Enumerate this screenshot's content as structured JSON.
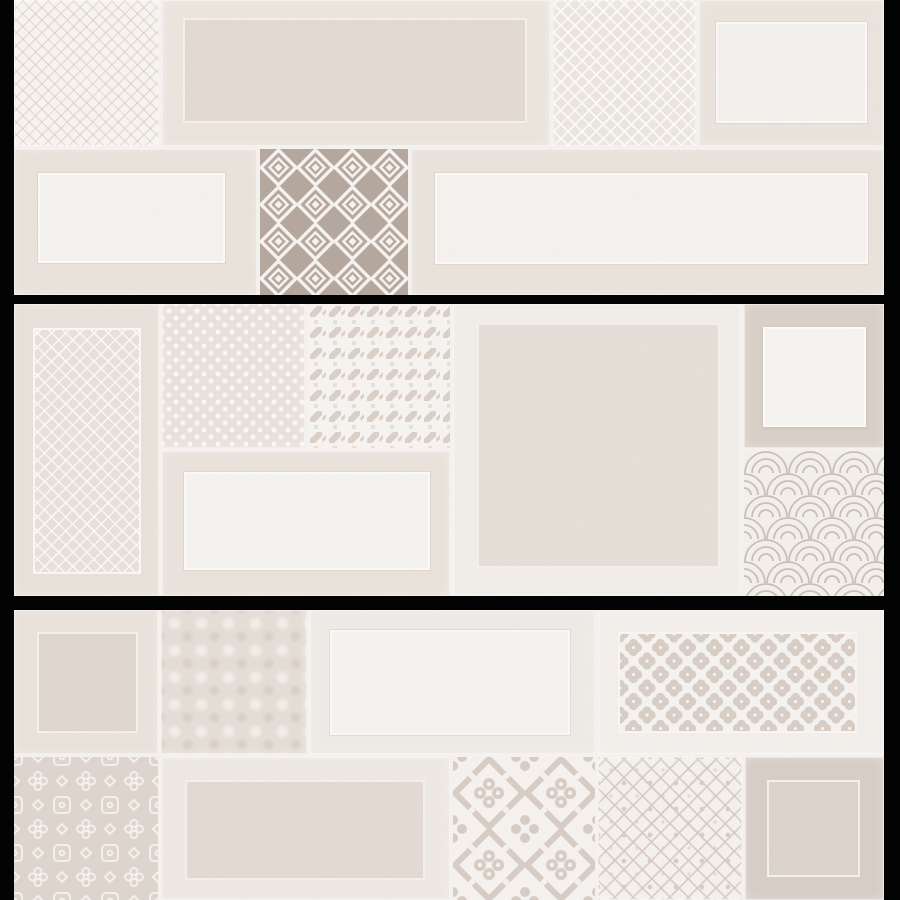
{
  "canvas": {
    "width": 900,
    "height": 900,
    "background": "#030303"
  },
  "panel": {
    "left": 14,
    "right": 884,
    "grout_color": "#f6f3f0"
  },
  "palette": {
    "background_black": "#030303",
    "grout_white": "#f6f3f0",
    "tile_white": "#f7f5f2",
    "tile_light_beige": "#eae4dd",
    "tile_beige": "#e3dbd3",
    "tile_dark_taupe": "#b2a49a",
    "tile_mid_taupe": "#d7cec6",
    "pattern_accent": "#d8cec5"
  },
  "strips": [
    {
      "name": "tile-strip-top",
      "y": 0,
      "height": 295,
      "tiles": [
        {
          "name": "tile-crosshatch",
          "pattern": "crosshatch",
          "x": 14,
          "y": 0,
          "w": 145,
          "h": 146,
          "base": "#f8f5f2"
        },
        {
          "name": "tile-framed-beige-wide",
          "pattern": "plain",
          "x": 162,
          "y": 0,
          "w": 388,
          "h": 146,
          "base": "#ebe5de",
          "inner": {
            "x": 183,
            "y": 18,
            "w": 344,
            "h": 105,
            "style": "dark",
            "fill": "#e2dad2"
          }
        },
        {
          "name": "tile-lattice",
          "pattern": "lattice",
          "x": 553,
          "y": 0,
          "w": 143,
          "h": 146,
          "base": "#ece6e0"
        },
        {
          "name": "tile-framed-blank-small",
          "pattern": "plain",
          "x": 699,
          "y": 0,
          "w": 185,
          "h": 146,
          "base": "#eae4dd",
          "inner": {
            "x": 716,
            "y": 22,
            "w": 151,
            "h": 101,
            "style": "light",
            "fill": "#f4f2ef"
          }
        },
        {
          "name": "tile-framed-blank-left",
          "pattern": "plain",
          "x": 14,
          "y": 149,
          "w": 243,
          "h": 146,
          "base": "#e9e3dc",
          "inner": {
            "x": 38,
            "y": 173,
            "w": 187,
            "h": 90,
            "style": "light",
            "fill": "#f5f3f0"
          }
        },
        {
          "name": "tile-diamond-squares",
          "pattern": "diamond",
          "x": 260,
          "y": 149,
          "w": 148,
          "h": 146,
          "base": "#b2a49a"
        },
        {
          "name": "tile-framed-blank-wide",
          "pattern": "plain",
          "x": 411,
          "y": 149,
          "w": 473,
          "h": 146,
          "base": "#e9e3dc",
          "inner": {
            "x": 435,
            "y": 173,
            "w": 433,
            "h": 91,
            "style": "light",
            "fill": "#f5f3f0"
          }
        }
      ]
    },
    {
      "name": "tile-strip-middle",
      "y": 304,
      "height": 292,
      "tiles": [
        {
          "name": "tile-tall-lattice-framed",
          "pattern": "plain",
          "x": 14,
          "y": 304,
          "w": 145,
          "h": 292,
          "base": "#e8e1da",
          "inner": {
            "x": 33,
            "y": 328,
            "w": 108,
            "h": 246,
            "style": "lattice",
            "fill": "#e8e1da"
          }
        },
        {
          "name": "tile-dot-lattice",
          "pattern": "dots",
          "x": 162,
          "y": 304,
          "w": 143,
          "h": 144,
          "base": "#e9e2db"
        },
        {
          "name": "tile-houndstooth",
          "pattern": "houndstooth",
          "x": 308,
          "y": 304,
          "w": 142,
          "h": 144,
          "base": "#f7f5f2"
        },
        {
          "name": "tile-framed-blank",
          "pattern": "plain",
          "x": 162,
          "y": 451,
          "w": 288,
          "h": 145,
          "base": "#eae3dc",
          "inner": {
            "x": 184,
            "y": 472,
            "w": 246,
            "h": 98,
            "style": "light",
            "fill": "#f6f4f1"
          }
        },
        {
          "name": "tile-big-framed-square",
          "pattern": "plain",
          "x": 453,
          "y": 304,
          "w": 288,
          "h": 292,
          "base": "#f2eeea",
          "inner": {
            "x": 477,
            "y": 323,
            "w": 243,
            "h": 245,
            "style": "dark",
            "fill": "#e6dfd8"
          }
        },
        {
          "name": "tile-framed-white-square",
          "pattern": "plain",
          "x": 744,
          "y": 304,
          "w": 140,
          "h": 144,
          "base": "#d8cfc7",
          "inner": {
            "x": 763,
            "y": 327,
            "w": 103,
            "h": 100,
            "style": "white",
            "fill": "#f7f5f2"
          }
        },
        {
          "name": "tile-scallop",
          "pattern": "scallop",
          "x": 744,
          "y": 451,
          "w": 140,
          "h": 145,
          "base": "#f4f1ed"
        }
      ]
    },
    {
      "name": "tile-strip-bottom",
      "y": 610,
      "height": 290,
      "tiles": [
        {
          "name": "tile-framed-dark-square",
          "pattern": "plain",
          "x": 14,
          "y": 610,
          "w": 144,
          "h": 144,
          "base": "#e9e3dc",
          "inner": {
            "x": 37,
            "y": 632,
            "w": 101,
            "h": 101,
            "style": "dark",
            "fill": "#ded6ce"
          }
        },
        {
          "name": "tile-damask-texture",
          "pattern": "damask",
          "x": 161,
          "y": 610,
          "w": 146,
          "h": 144,
          "base": "#e5ded7"
        },
        {
          "name": "tile-framed-blank-top",
          "pattern": "plain",
          "x": 310,
          "y": 610,
          "w": 285,
          "h": 144,
          "base": "#efebe7",
          "inner": {
            "x": 330,
            "y": 630,
            "w": 240,
            "h": 105,
            "style": "light",
            "fill": "#f6f4f1"
          }
        },
        {
          "name": "tile-quatrefoil-panel",
          "pattern": "plain",
          "x": 598,
          "y": 610,
          "w": 286,
          "h": 144,
          "base": "#f3f0ed",
          "inner": {
            "x": 618,
            "y": 632,
            "w": 239,
            "h": 101,
            "style": "qpanel",
            "fill": "#f6f4f1",
            "pattern": "quatrefoil"
          }
        },
        {
          "name": "tile-arabesque",
          "pattern": "arabesque",
          "x": 14,
          "y": 757,
          "w": 144,
          "h": 143,
          "base": "#ddd5cd"
        },
        {
          "name": "tile-framed-beige-bottom",
          "pattern": "plain",
          "x": 161,
          "y": 757,
          "w": 289,
          "h": 143,
          "base": "#eee9e4",
          "inner": {
            "x": 185,
            "y": 780,
            "w": 240,
            "h": 100,
            "style": "dark",
            "fill": "#e3dbd3"
          }
        },
        {
          "name": "tile-moroccan",
          "pattern": "moroccan",
          "x": 453,
          "y": 757,
          "w": 142,
          "h": 143,
          "base": "#f6f3f0"
        },
        {
          "name": "tile-diamond-ikat",
          "pattern": "ikat",
          "x": 598,
          "y": 757,
          "w": 144,
          "h": 143,
          "base": "#f5f2ef"
        },
        {
          "name": "tile-framed-line-square",
          "pattern": "plain",
          "x": 745,
          "y": 757,
          "w": 139,
          "h": 143,
          "base": "#d6cdc5",
          "inner": {
            "x": 767,
            "y": 780,
            "w": 93,
            "h": 97,
            "style": "line",
            "fill": "#dbd3cb"
          }
        }
      ]
    }
  ]
}
